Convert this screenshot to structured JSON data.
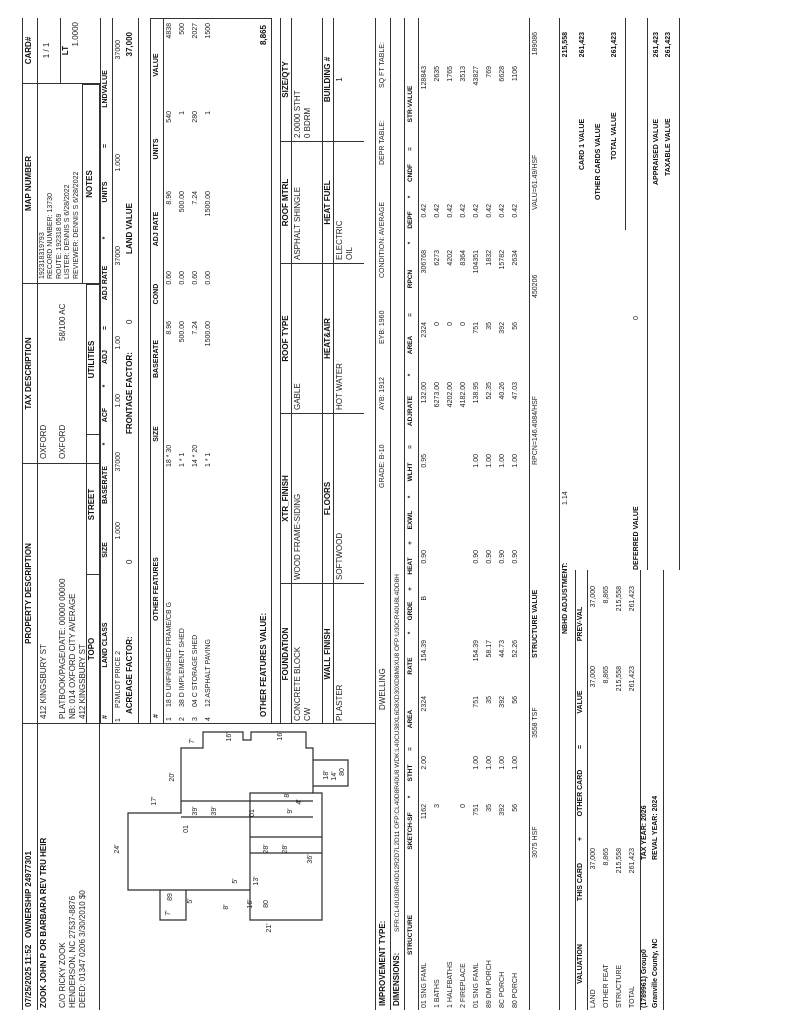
{
  "header": {
    "printed": "07/25/2025 11:52",
    "ownership": "OWNERSHIP 24977301",
    "property_description_label": "PROPERTY DESCRIPTION",
    "tax_description_label": "TAX DESCRIPTION",
    "map_number_label": "MAP NUMBER",
    "card_label": "CARD#",
    "card_value": "1 / 1",
    "lt_label": "LT",
    "lt_value": "1.0000"
  },
  "owner": {
    "name": "ZOOK JOHN P OR BARBARA REV TRU HEIR",
    "care_of": "C/O RICKY ZOOK",
    "city_line": "HENDERSON, NC 27537-8876",
    "deed_line": "DEED: 01347 0206 3/30/2010 $0"
  },
  "property": {
    "address": "412 KINGSBURY ST",
    "platbook": "PLATBOOK/PAGE/DATE: 00000 00000",
    "neighborhood": "NB: 014 OXFORD CITY AVERAGE",
    "address2": "412 KINGSBURY ST"
  },
  "tax": {
    "line1": "OXFORD",
    "line2": "OXFORD",
    "acreage": "58/100 AC"
  },
  "map": {
    "number": "192318319793",
    "record": "RECORD NUMBER: 13730",
    "route": "ROUTE: 192318 059",
    "lister": "LISTER: DENNIS S 6/28/2022",
    "reviewer": "REVIEWER: DENNIS S 6/28/2022",
    "notes_label": "NOTES"
  },
  "site": {
    "topo": "TOPO",
    "street": "STREET",
    "utilities": "UTILITIES"
  },
  "land": {
    "headers": [
      "#",
      "LAND CLASS",
      "SIZE",
      "BASERATE",
      "*",
      "ACF",
      "*",
      "ADJ",
      "=",
      "ADJ RATE",
      "*",
      "UNITS",
      "=",
      "LNDVALUE"
    ],
    "row": [
      "1",
      "P2MLOT PRICE 2",
      "1.000",
      "37000",
      "1.00",
      "1.00",
      "37000",
      "1.000",
      "37000"
    ],
    "acreage_factor_label": "ACREAGE FACTOR:",
    "acreage_factor": "0",
    "frontage_factor_label": "FRONTAGE FACTOR:",
    "frontage_factor": "0",
    "land_value_label": "LAND VALUE",
    "land_value": "37,000"
  },
  "other_features": {
    "headers": [
      "#",
      "OTHER FEATURES",
      "SIZE",
      "BASERATE",
      "COND",
      "ADJ RATE",
      "UNITS",
      "VALUE"
    ],
    "rows": [
      [
        "1",
        "18 D UNFINISHED FRAME/CB G",
        "18 * 30",
        "8.96",
        "0.60",
        "8.96",
        "540",
        "4838"
      ],
      [
        "2",
        "38 D IMPLEMENT SHED",
        "1 * 1",
        "500.00",
        "0.00",
        "500.00",
        "1",
        "500"
      ],
      [
        "3",
        "04 C STORAGE SHED",
        "14 * 20",
        "7.24",
        "0.60",
        "7.24",
        "280",
        "2027"
      ],
      [
        "4",
        "12 ASPHALT PAVING",
        "1 * 1",
        "1500.00",
        "0.00",
        "1500.00",
        "1",
        "1500"
      ]
    ],
    "total_label": "OTHER FEATURES VALUE:",
    "total": "8,865"
  },
  "building": {
    "foundation_label": "FOUNDATION",
    "foundation": "CONCRETE BLOCK",
    "foundation2": "CW",
    "xtr_finish_label": "XTR_FINISH",
    "xtr_finish": "WOOD FRAME-SIDING",
    "roof_type_label": "ROOF TYPE",
    "roof_type": "GABLE",
    "roof_mtrl_label": "ROOF MTRL",
    "roof_mtrl": "ASPHALT SHINGLE",
    "size_qty_label": "SIZE/QTY",
    "size_qty": "2.0000 STHT",
    "size_qty2": "0 BDRM",
    "wall_finish_label": "WALL FINISH",
    "wall_finish": "PLASTER",
    "floors_label": "FLOORS",
    "floors": "SOFTWOOD",
    "heat_air_label": "HEAT&AIR",
    "heat_air": "HOT WATER",
    "heat_fuel_label": "HEAT FUEL",
    "heat_fuel": "ELECTRIC",
    "heat_fuel2": "OIL",
    "building_num_label": "BUILDING #",
    "building_num": "1"
  },
  "improvement": {
    "type_label": "IMPROVEMENT TYPE:",
    "type": "DWELLING",
    "grade": "GRADE: B-10",
    "ayb": "AYB: 1912",
    "eyb": "EYB: 1960",
    "condition": "CONDITION: AVERAGE",
    "depr": "DEPR TABLE:",
    "sqft": "SQ FT TABLE:",
    "dims_label": "DIMENSIONS:",
    "dims": "SFR:CL40U30R40D12R2D7L2D11 OFP:CL40D8R40U8 WDK:L40CU38XL6D8XD30XD8M6XU8 OFP:U30CR40U8L4DD8H"
  },
  "structure": {
    "headers": [
      "STRUCTURE",
      "SKETCH-SF",
      "*",
      "STHT",
      "=",
      "AREA",
      "RATE",
      "*",
      "GRDE",
      "+",
      "HEAT",
      "+",
      "EXWL",
      "*",
      "WLHT",
      "=",
      "ADJRATE",
      "*",
      "AREA",
      "=",
      "RPCN",
      "*",
      "DEPF",
      "*",
      "CNDF",
      "=",
      "STR-VALUE"
    ],
    "rows": [
      [
        "01 SNG FAML",
        "1162",
        "2.00",
        "2324",
        "154.39",
        "B",
        "0.90",
        "",
        "0.95",
        "132.00",
        "2324",
        "306768",
        "0.42",
        "",
        "128843"
      ],
      [
        "1 BATHS",
        "3",
        "",
        "",
        "",
        "",
        "",
        "",
        "",
        "6273.00",
        "0",
        "6273",
        "0.42",
        "",
        "2635"
      ],
      [
        "1 HALFBATHS",
        "",
        "",
        "",
        "",
        "",
        "",
        "",
        "",
        "4202.00",
        "0",
        "4202",
        "0.42",
        "",
        "1765"
      ],
      [
        "2 FIREPLACE",
        "0",
        "",
        "",
        "",
        "",
        "",
        "",
        "",
        "4182.00",
        "0",
        "8364",
        "0.42",
        "",
        "3513"
      ],
      [
        "01 SNG FAML",
        "751",
        "1.00",
        "751",
        "154.39",
        "",
        "0.90",
        "",
        "1.00",
        "138.95",
        "751",
        "104351",
        "0.42",
        "",
        "43827"
      ],
      [
        "89 DM PORCH",
        "35",
        "1.00",
        "35",
        "58.17",
        "",
        "0.90",
        "",
        "1.00",
        "52.35",
        "35",
        "1832",
        "0.42",
        "",
        "769"
      ],
      [
        "8C PORCH",
        "392",
        "1.00",
        "392",
        "44.73",
        "",
        "0.90",
        "",
        "1.00",
        "40.26",
        "392",
        "15782",
        "0.42",
        "",
        "6628"
      ],
      [
        "80 PORCH",
        "56",
        "1.00",
        "56",
        "52.26",
        "",
        "0.90",
        "",
        "1.00",
        "47.03",
        "56",
        "2634",
        "0.42",
        "",
        "1106"
      ]
    ],
    "totals": {
      "hsf": "3075  HSF",
      "tsf": "3558  TSF",
      "structure_value_label": "STRUCTURE VALUE",
      "rpcn_per": "RPCN=146.4084/HSF",
      "rpcn_total": "450206",
      "valu_per": "VALU=61.49/HSF",
      "str_value": "189086"
    }
  },
  "summary": {
    "nbhd_label": "NBHD ADJUSTMENT:",
    "nbhd": "1.14",
    "adjusted": "215,558",
    "card1_label": "CARD 1 VALUE",
    "card1": "261,423",
    "other_cards_label": "OTHER CARDS VALUE",
    "total_label": "TOTAL VALUE",
    "total": "261,423",
    "deferred_label": "DEFERRED VALUE",
    "deferred": "0",
    "appraised_label": "APPRAISED VALUE",
    "appraised": "261,423",
    "taxable_label": "TAXABLE VALUE",
    "taxable": "261,423"
  },
  "valuation": {
    "headers": [
      "VALUATION",
      "THIS CARD",
      "+",
      "OTHER CARD",
      "=",
      "VALUE",
      "PREV-VAL"
    ],
    "rows": [
      [
        "LAND",
        "37,000",
        "",
        "37,000",
        "37,000"
      ],
      [
        "OTHER FEAT",
        "8,865",
        "",
        "8,865",
        "8,865"
      ],
      [
        "STRUCTURE",
        "215,558",
        "",
        "215,558",
        "215,558"
      ],
      [
        "TOTAL",
        "261,423",
        "",
        "261,423",
        "261,423"
      ]
    ],
    "group": "(1789961) Group0",
    "county": "Granville County, NC",
    "tax_year": "TAX YEAR: 2026",
    "reval_year": "REVAL YEAR: 2024"
  },
  "sketch": {
    "paths": [
      "M134,128 L211,128 L211,181 L276,181 L276,203 L292,203 L292,243 L284,243 L284,251 L292,251 L292,306 L276,306 L276,313 L231,313 L231,322 L104,322 L104,250 L134,250 Z",
      "M134,160 L104,160 L104,186 L134,186",
      "M238,313 L238,348 L264,348 L264,313",
      "M207,181 L207,313",
      "M223,181 L223,313",
      "M171,250 L171,322",
      "M187,250 L187,322",
      "M134,250 L231,250 L231,313"
    ],
    "labels": [
      {
        "x": 175,
        "y": 119,
        "t": "24'"
      },
      {
        "x": 223,
        "y": 156,
        "t": "17'"
      },
      {
        "x": 247,
        "y": 174,
        "t": "20'"
      },
      {
        "x": 283,
        "y": 194,
        "t": "7'"
      },
      {
        "x": 287,
        "y": 231,
        "t": "16'"
      },
      {
        "x": 288,
        "y": 282,
        "t": "16'"
      },
      {
        "x": 195,
        "y": 188,
        "t": "01"
      },
      {
        "x": 213,
        "y": 197,
        "t": "39'"
      },
      {
        "x": 213,
        "y": 216,
        "t": "39'"
      },
      {
        "x": 211,
        "y": 254,
        "t": "01"
      },
      {
        "x": 175,
        "y": 268,
        "t": "28'"
      },
      {
        "x": 175,
        "y": 287,
        "t": "28'"
      },
      {
        "x": 165,
        "y": 312,
        "t": "36'"
      },
      {
        "x": 96,
        "y": 271,
        "t": "21'"
      },
      {
        "x": 120,
        "y": 252,
        "t": "16'"
      },
      {
        "x": 120,
        "y": 268,
        "t": "80"
      },
      {
        "x": 143,
        "y": 258,
        "t": "13'"
      },
      {
        "x": 143,
        "y": 237,
        "t": "5'"
      },
      {
        "x": 117,
        "y": 228,
        "t": "8'"
      },
      {
        "x": 111,
        "y": 170,
        "t": "7'"
      },
      {
        "x": 127,
        "y": 172,
        "t": "89"
      },
      {
        "x": 123,
        "y": 192,
        "t": "5'"
      },
      {
        "x": 229,
        "y": 289,
        "t": "8'"
      },
      {
        "x": 213,
        "y": 292,
        "t": "9'"
      },
      {
        "x": 222,
        "y": 301,
        "t": "4'"
      },
      {
        "x": 249,
        "y": 328,
        "t": "18'"
      },
      {
        "x": 248,
        "y": 336,
        "t": "14'"
      },
      {
        "x": 252,
        "y": 344,
        "t": "80"
      }
    ]
  }
}
